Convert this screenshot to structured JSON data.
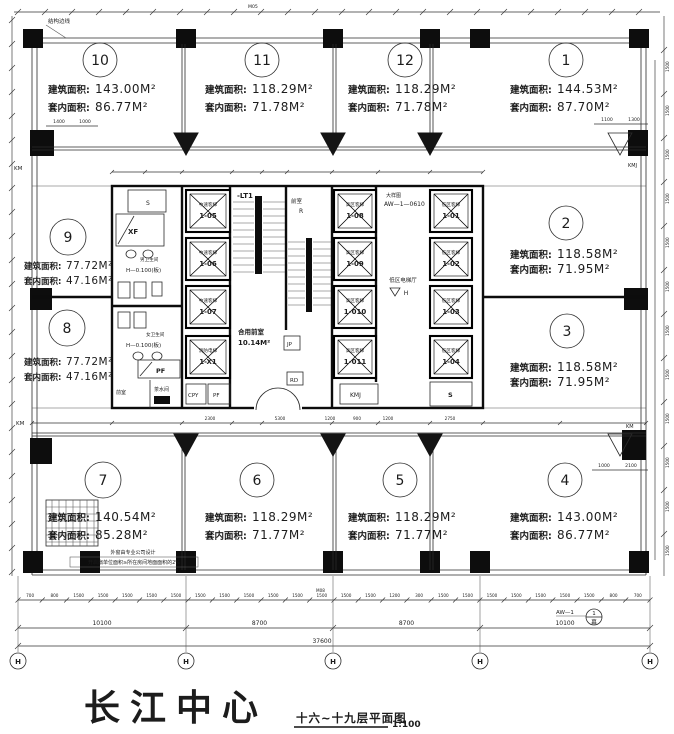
{
  "project": {
    "name": "长江中心",
    "drawing_title": "十六~十九层平面图",
    "scale": "1:100"
  },
  "labels": {
    "gross_area": "建筑面积:",
    "net_area": "套内面积:"
  },
  "units": [
    {
      "no": "1",
      "gross": "144.53M²",
      "net": "87.70M²"
    },
    {
      "no": "2",
      "gross": "118.58M²",
      "net": "71.95M²"
    },
    {
      "no": "3",
      "gross": "118.58M²",
      "net": "71.95M²"
    },
    {
      "no": "4",
      "gross": "143.00M²",
      "net": "86.77M²"
    },
    {
      "no": "5",
      "gross": "118.29M²",
      "net": "71.77M²"
    },
    {
      "no": "6",
      "gross": "118.29M²",
      "net": "71.77M²"
    },
    {
      "no": "7",
      "gross": "140.54M²",
      "net": "85.28M²"
    },
    {
      "no": "8",
      "gross": "77.72M²",
      "net": "47.16M²"
    },
    {
      "no": "9",
      "gross": "77.72M²",
      "net": "47.16M²"
    },
    {
      "no": "10",
      "gross": "143.00M²",
      "net": "86.77M²"
    },
    {
      "no": "11",
      "gross": "118.29M²",
      "net": "71.78M²"
    },
    {
      "no": "12",
      "gross": "118.29M²",
      "net": "71.78M²"
    }
  ],
  "core": {
    "stair1": "-LT1",
    "front_room": "前室",
    "front_room_mark": "R",
    "mens_toilet": "男卫生间",
    "womens_toilet": "女卫生间",
    "level_note": "H—0.100(板)",
    "xf": "XF",
    "s_top": "S",
    "pf_room": "PF",
    "tea_room": "茶水间",
    "front_small": "前室",
    "cpy": "CPY",
    "pf_shaft": "PF",
    "jp": "JP",
    "rd": "RD",
    "kmj": "KMJ",
    "s_shaft": "S",
    "shared_front": "合用前室",
    "shared_front_area": "10.14M²",
    "hall": "低区电梯厅",
    "hall_mark": "H",
    "detail_note": "大样图",
    "detail_ref": "AW—1—0610",
    "elevators_left": [
      {
        "type": "中速客梯",
        "id": "1-05"
      },
      {
        "type": "中速客梯",
        "id": "1-06"
      },
      {
        "type": "中速客梯",
        "id": "1-07"
      },
      {
        "type": "消防电梯",
        "id": "1-X1"
      }
    ],
    "elevators_mid": [
      {
        "type": "高区客梯",
        "id": "1-08"
      },
      {
        "type": "高区客梯",
        "id": "1-09"
      },
      {
        "type": "高区客梯",
        "id": "1-010"
      },
      {
        "type": "高区客梯",
        "id": "1-011"
      }
    ],
    "elevators_right": [
      {
        "type": "低区客梯",
        "id": "1-01"
      },
      {
        "type": "低区客梯",
        "id": "1-02"
      },
      {
        "type": "低区客梯",
        "id": "1-03"
      },
      {
        "type": "低区客梯",
        "id": "1-04"
      }
    ]
  },
  "annotations": {
    "structure_edge": "结构边线",
    "window_note1": "外窗由专业公司设计",
    "window_note2": "开启扇单位面积≥所在房间地面面积的2%",
    "km_left_top": "KM",
    "km_left_mid": "KM",
    "kmj_right_top": "KMJ",
    "km_right_mid": "KM",
    "door_tag_top": "M05",
    "door_tag_bottom": "M08",
    "curtain_ref": "AW—1",
    "curtain_bubble_top": "1",
    "curtain_bubble_bottom": "幕"
  },
  "dimensions": {
    "spans": [
      "10100",
      "8700",
      "8700",
      "10100"
    ],
    "total": "37600",
    "grid_bubbles": [
      "H",
      "H",
      "H",
      "H",
      "H"
    ],
    "bottom_ticks": [
      "700",
      "800",
      "1500",
      "1500",
      "1500",
      "1500",
      "1500",
      "1500",
      "1500",
      "1500",
      "1500",
      "1500",
      "1500",
      "1500",
      "1500",
      "1200",
      "300",
      "1500",
      "1500",
      "1500",
      "1500",
      "1500",
      "1500",
      "1500",
      "800",
      "700"
    ],
    "right_ticks": [
      "1500",
      "1500",
      "1500",
      "1500",
      "1500",
      "1500",
      "1500",
      "1500",
      "1500",
      "1500",
      "1500",
      "1500"
    ],
    "small_dims": {
      "unit10": [
        "1400",
        "1000"
      ],
      "unit1": [
        "1100",
        "1300"
      ],
      "unit4": [
        "1000",
        "2100"
      ],
      "mid_chain": [
        "2300",
        "5300",
        "1200",
        "900",
        "1200",
        "2750"
      ]
    }
  }
}
